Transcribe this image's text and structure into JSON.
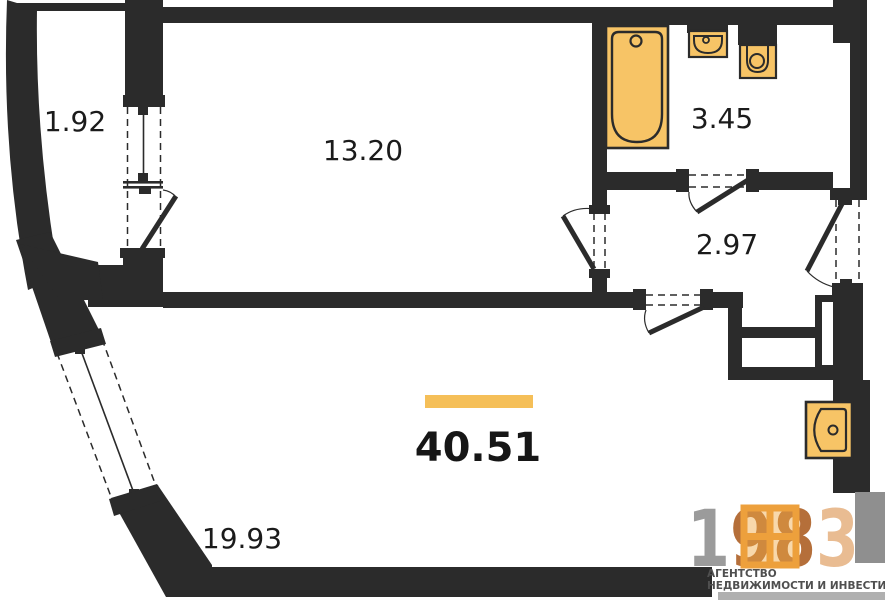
{
  "floor_plan": {
    "rooms": [
      {
        "name": "balcony",
        "area": "1.92"
      },
      {
        "name": "bedroom",
        "area": "13.20"
      },
      {
        "name": "bathroom",
        "area": "3.45"
      },
      {
        "name": "hallway",
        "area": "2.97"
      },
      {
        "name": "living-room",
        "area": "19.93"
      }
    ],
    "total_area": "40.51",
    "fixtures": [
      "bathtub-icon",
      "bathroom-sink-icon",
      "toilet-icon",
      "kitchen-sink-icon"
    ],
    "colors": {
      "wall": "#2b2b2b",
      "fixture_fill": "#f7c466",
      "fixture_stroke": "#2b2b2b",
      "accent_bar": "#f5bf58"
    }
  },
  "logo": {
    "digits": [
      {
        "char": "1",
        "color": "#9b9b9b"
      },
      {
        "char": "9",
        "color": "#b56f3a"
      },
      {
        "char": "8",
        "color": "#b56f3a"
      },
      {
        "char": "3",
        "color": "#e9bc92"
      }
    ],
    "tagline_line1": "АГЕНТСТВО",
    "tagline_line2": "НЕДВИЖИМОСТИ И ИНВЕСТИЦИЙ",
    "window_icon_color": "#eda03c",
    "text_color": "#4f4f4f",
    "gray_block_color": "#8f8f8f",
    "bottom_strip_color": "#b0b0b0"
  }
}
